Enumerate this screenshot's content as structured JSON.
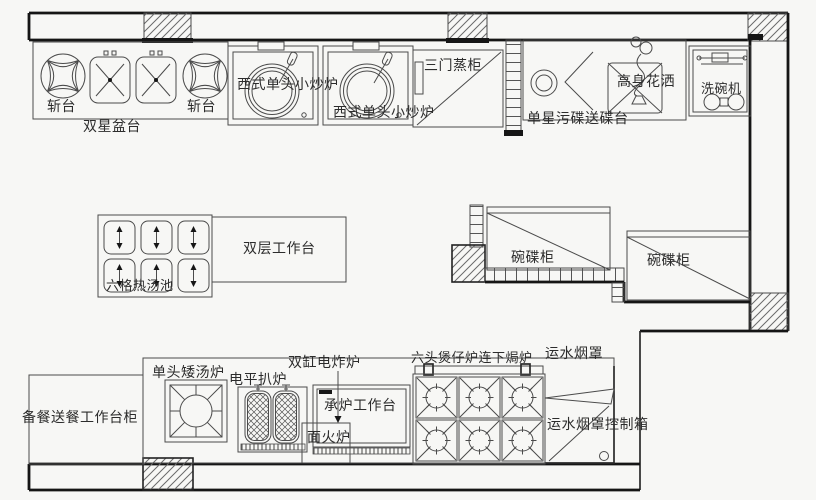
{
  "colors": {
    "background": "#f7f7f5",
    "line": "#4b4b4b",
    "wall": "#151515",
    "text": "#2c2c2c"
  },
  "labels": {
    "chopping_left": "斩台",
    "chopping_right": "斩台",
    "double_sink_table": "双星盆台",
    "wok_stove_1": "西式单头小炒炉",
    "wok_stove_2": "西式单头小炒炉",
    "steam_cabinet": "三门蒸柜",
    "soiled_dish_table": "单星污碟送碟台",
    "tall_spray": "高身花洒",
    "dishwasher": "洗碗机",
    "double_worktable": "双层工作台",
    "six_soup_pool": "六格热汤池",
    "dish_cabinet_1": "碗碟柜",
    "dish_cabinet_2": "碗碟柜",
    "prep_serving_cabinet": "备餐送餐工作台柜",
    "stock_pot_stove": "单头矮汤炉",
    "electric_griddle": "电平扒炉",
    "double_fryer": "双缸电炸炉",
    "stove_stand_table": "承炉工作台",
    "salamander": "面火炉",
    "six_burner_range_oven": "六头煲仔炉连下焗炉",
    "water_hood": "运水烟罩",
    "hood_control_box": "运水烟罩控制箱"
  }
}
